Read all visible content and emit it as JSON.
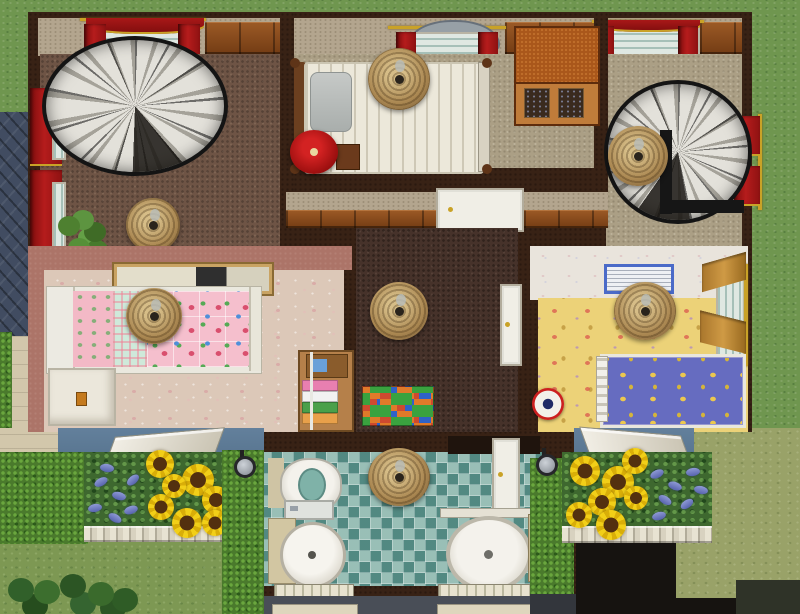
{
  "meta": {
    "scene_label": "Top-down cutaway view of a house in a life-simulation game",
    "view": "floorplan"
  },
  "palette": {
    "outer_wall": "#382215",
    "wood_paneling": "#8a4a1c",
    "upper_carpet": "#6e5445",
    "bedroom_carpet": "#ab9f85",
    "hallway_carpet": "#46322a",
    "nursery_carpet": "#dcc8b8",
    "nursery_wall": "#ac7468",
    "kids_room_carpet": "#ecd278",
    "bathroom_tile": "#74a79e",
    "exterior_siding": "#5a7389",
    "roof_slate": "#414c61",
    "grass": "#6f964f",
    "lawn_olive": "#99a268",
    "hedge": "#4a7a2c",
    "curtain_red": "#a81818",
    "curtain_gold_trim": "#c9a227",
    "curtain_tan": "#cf9a45",
    "wicker_lamp": "#aa8751",
    "sunflower_yellow": "#f2cf18",
    "bluebell_blue": "#5763ad",
    "kids_bed_blue": "#666cc0",
    "nursery_bed_pink": "#f5bfcd",
    "rug_colors": [
      "#cf4a2f",
      "#2f62c8",
      "#3aa23f",
      "#e07a2a"
    ]
  },
  "labels": {
    "scene": "House floorplan view",
    "spiral_stair_left": "Spiral staircase (left)",
    "spiral_stair_right": "Spiral staircase (right)",
    "double_bed": "Double bed with striped linens",
    "red_pouf": "Round red pouf",
    "nightstand": "Wooden end table",
    "cabinet": "Wooden display cabinet",
    "wicker_lamp": "Wicker ceiling lamp",
    "potted_plant": "Potted plant",
    "window_red": "Window with red curtains",
    "hall_door": "White interior door",
    "nursery_bed": "Child bed with pink floral blanket",
    "white_dresser": "White dresser",
    "toy_shelf": "Toy storage shelf",
    "painting": "Framed wall painting",
    "kids_painting": "Blue framed picture",
    "play_rug": "Colorful checkered play rug",
    "kids_bed": "Kids bed with moon-and-stars blanket",
    "roly_toy": "Red wobble toy",
    "window_tan": "Window with tan curtains",
    "toilet": "Toilet",
    "sink": "Pedestal sink",
    "shower": "Corner shower stall",
    "bath_door": "Bathroom door",
    "sunflower": "Sunflower",
    "bluebells": "Blue flowers",
    "hedge": "Hedge",
    "fence": "White picket fence",
    "awning": "Exterior window awning",
    "wall_lamp": "Outdoor wall lamp",
    "roof": "Slate roof section",
    "porch_step": "Porch step"
  }
}
